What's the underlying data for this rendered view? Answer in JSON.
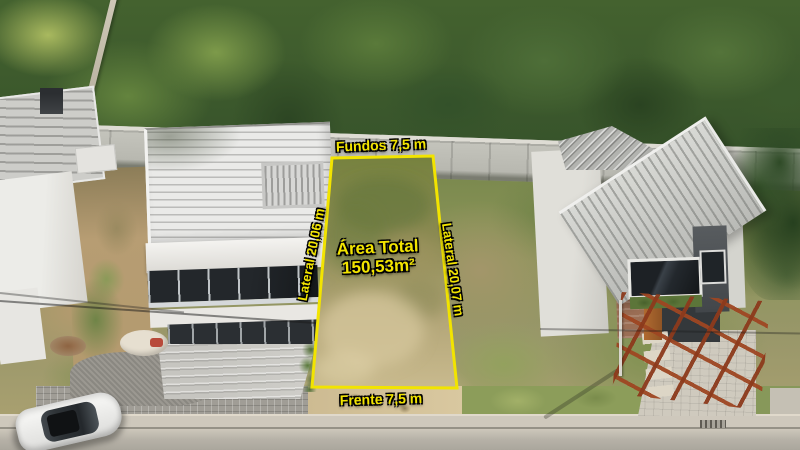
{
  "meta": {
    "description": "Aerial drone photo of a residential land lot for sale between two modern houses, with surveyed lot dimensions overlaid in yellow"
  },
  "colors": {
    "accent": "#f2e400",
    "outline": "#000000"
  },
  "lot": {
    "back_label": "Fundos 7,5 m",
    "left_side_label": "Lateral 20,06 m",
    "right_side_label": "Lateral 20,07 m",
    "front_label": "Frente 7,5 m",
    "area_title": "Área Total",
    "area_value": "150,53m²"
  }
}
